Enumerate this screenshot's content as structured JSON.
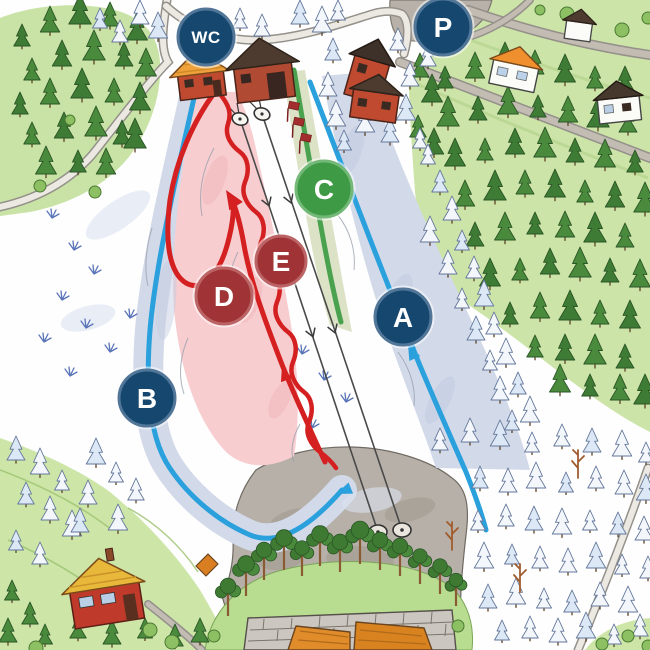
{
  "map": {
    "title": "Ski slope trail map",
    "markers": {
      "wc": {
        "label": "WC",
        "kind": "toilets-marker",
        "color": "#16486f",
        "rim": "#527698"
      },
      "parking": {
        "label": "P",
        "kind": "parking-marker",
        "color": "#16486f",
        "rim": "#527698"
      },
      "trail_a": {
        "label": "A",
        "kind": "ski-trail-marker",
        "color": "#16486f",
        "rim": "#527698"
      },
      "trail_b": {
        "label": "B",
        "kind": "ski-trail-marker",
        "color": "#16486f",
        "rim": "#527698"
      },
      "trail_c": {
        "label": "C",
        "kind": "ski-trail-marker",
        "color": "#3e9a44",
        "rim": "#74b878"
      },
      "trail_d": {
        "label": "D",
        "kind": "ski-trail-marker",
        "color": "#a03336",
        "rim": "#bb6466"
      },
      "trail_e": {
        "label": "E",
        "kind": "ski-trail-marker",
        "color": "#a03336",
        "rim": "#bb6466"
      }
    },
    "trail_lines": {
      "blue": "#2aa0dc",
      "red": "#d42020",
      "green": "#4aa24f"
    },
    "slope_fills": {
      "blue_slope": "#d2d9e9",
      "red_slope": "#f7cdd0",
      "green_slope": "#dbe2c6"
    },
    "gate_color": "#a32e2e"
  }
}
